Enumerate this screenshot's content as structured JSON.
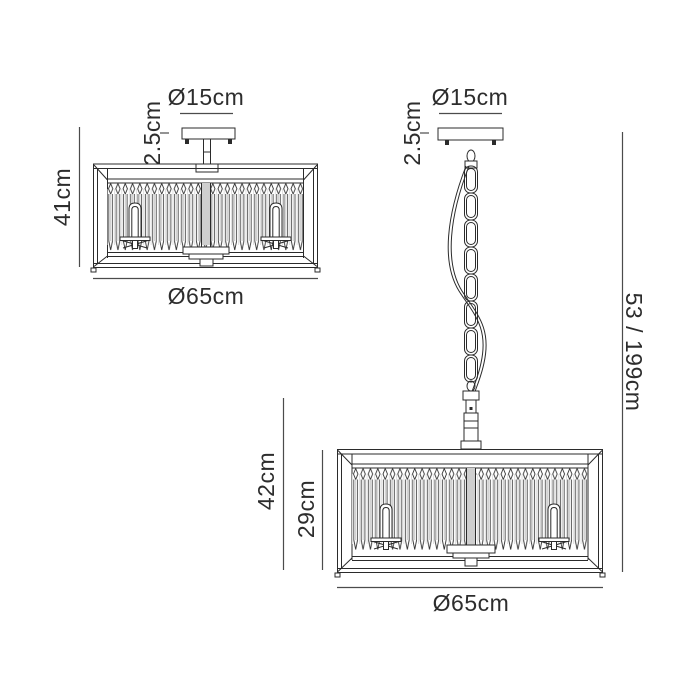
{
  "diagram_type": "lighting-product-dimension-drawing",
  "colors": {
    "background": "#ffffff",
    "fixture_line": "#2b2b2b",
    "dimension_line": "#4b4b4b",
    "text": "#2d2d2d",
    "back_crystal_hint": "#c7c7c7"
  },
  "views": {
    "semiflush": {
      "name": "semi-flush ceiling fixture",
      "canopy_diameter": "Ø15cm",
      "canopy_height": "2.5cm",
      "fixture_height": "41cm",
      "shade_diameter": "Ø65cm"
    },
    "pendant": {
      "name": "chain pendant fixture",
      "canopy_diameter": "Ø15cm",
      "canopy_height": "2.5cm",
      "drop_range": "53 / 199cm",
      "body_height": "42cm",
      "shade_height": "29cm",
      "shade_diameter": "Ø65cm"
    }
  }
}
